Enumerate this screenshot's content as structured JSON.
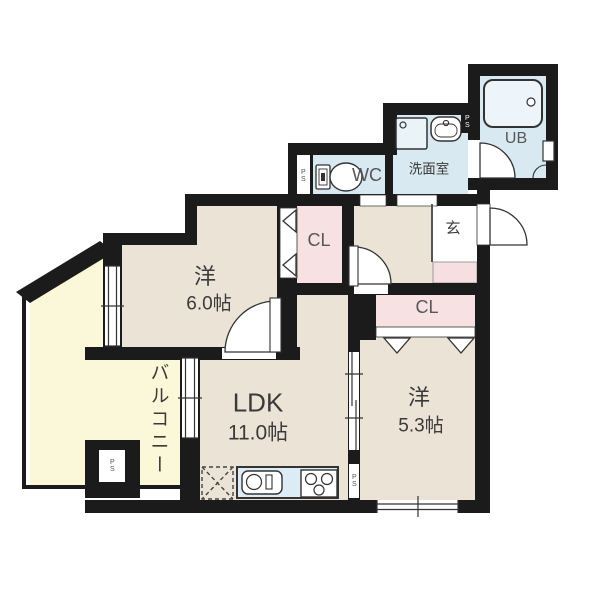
{
  "plan": {
    "title": "apartment-floor-plan",
    "rooms": {
      "western_room_6": {
        "label": "洋",
        "size": "6.0帖"
      },
      "ldk": {
        "label": "LDK",
        "size": "11.0帖"
      },
      "western_room_53": {
        "label": "洋",
        "size": "5.3帖"
      },
      "balcony": {
        "label": "バルコニー"
      },
      "wc": {
        "label": "WC"
      },
      "washroom": {
        "label": "洗面室"
      },
      "unit_bath": {
        "label": "UB"
      },
      "entrance": {
        "label": "玄"
      },
      "closet_1": {
        "label": "CL"
      },
      "closet_2": {
        "label": "CL"
      },
      "pipe_space_wc": {
        "label": "PS"
      },
      "pipe_space_washroom": {
        "label": "PS"
      },
      "pipe_space_kitchen": {
        "label": "PS"
      },
      "pipe_space_balcony": {
        "label": "PS"
      }
    },
    "colors": {
      "wall": "#1b1b1b",
      "room_floor": "#ebe3d6",
      "closet_floor": "#f8e1e3",
      "entrance_step": "#f6dee1",
      "wet_area_floor": "#d9e9f2",
      "balcony_floor": "#fbf8da",
      "kitchen_counter": "#dcebf4",
      "fixture_fill": "#ffffff",
      "line": "#333333"
    }
  }
}
